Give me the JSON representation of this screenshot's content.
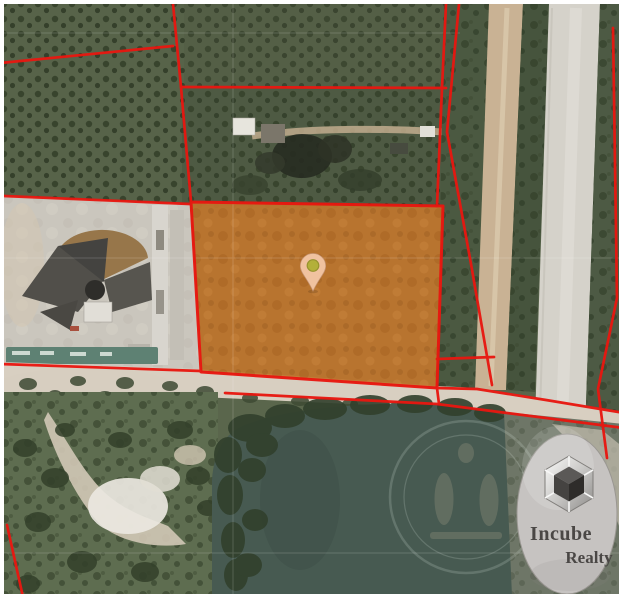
{
  "brand": {
    "line1": "Incube",
    "line2": "Realty"
  },
  "icons": {
    "logo": "cube-3d-icon",
    "marker": "location-pin-icon",
    "watermark": "round-seal-watermark"
  },
  "colors": {
    "boundary_red": "#e81710",
    "parcel_fill": "#c0752d",
    "pin_body": "#f4c7a6",
    "pin_dot": "#b3b039",
    "pond": "#475a51",
    "logo_bg": "#c6c3c1",
    "frame": "#ffffff"
  }
}
